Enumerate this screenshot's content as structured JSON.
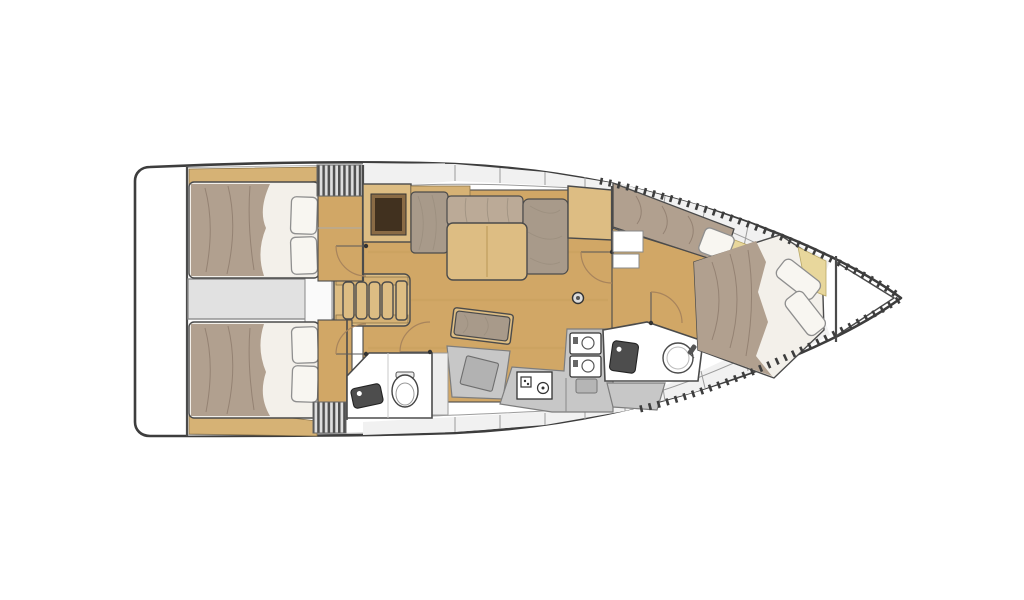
{
  "figure": {
    "kind": "sailboat-interior-floor-plan",
    "view": "top-down",
    "orientation": "bow-right"
  },
  "colors": {
    "background": "#ffffff",
    "hull_stroke": "#3d3d3d",
    "wall_stroke": "#4b4b4b",
    "deck_band": "#f1f1f1",
    "deck_line": "#9c9c9c",
    "wood_floor": "#d1a766",
    "wood_light": "#ddbd83",
    "wood_trim": "#d6b275",
    "cabinet_face": "#8a6b45",
    "cabinet_dark": "#41311f",
    "duvet": "#b1a08f",
    "duvet_crease": "#8d7a6b",
    "sheet_white": "#f3f0ea",
    "pillow": "#f8f6f1",
    "pillow_stroke": "#8f8f8f",
    "cushion": "#a89a8a",
    "cushion_light": "#bbaa97",
    "corridor_gray": "#e1e1e1",
    "corridor_stroke": "#8d8d8d",
    "counter_gray": "#c7c7c7",
    "counter_pad": "#b2b2b2",
    "fixture_dark": "#4d4d4d",
    "room_white": "#ffffff",
    "stripe_dark": "#505050",
    "stripe_light": "#dedede",
    "accent_yellow": "#e8d79c",
    "door_arc": "#a8845c"
  }
}
